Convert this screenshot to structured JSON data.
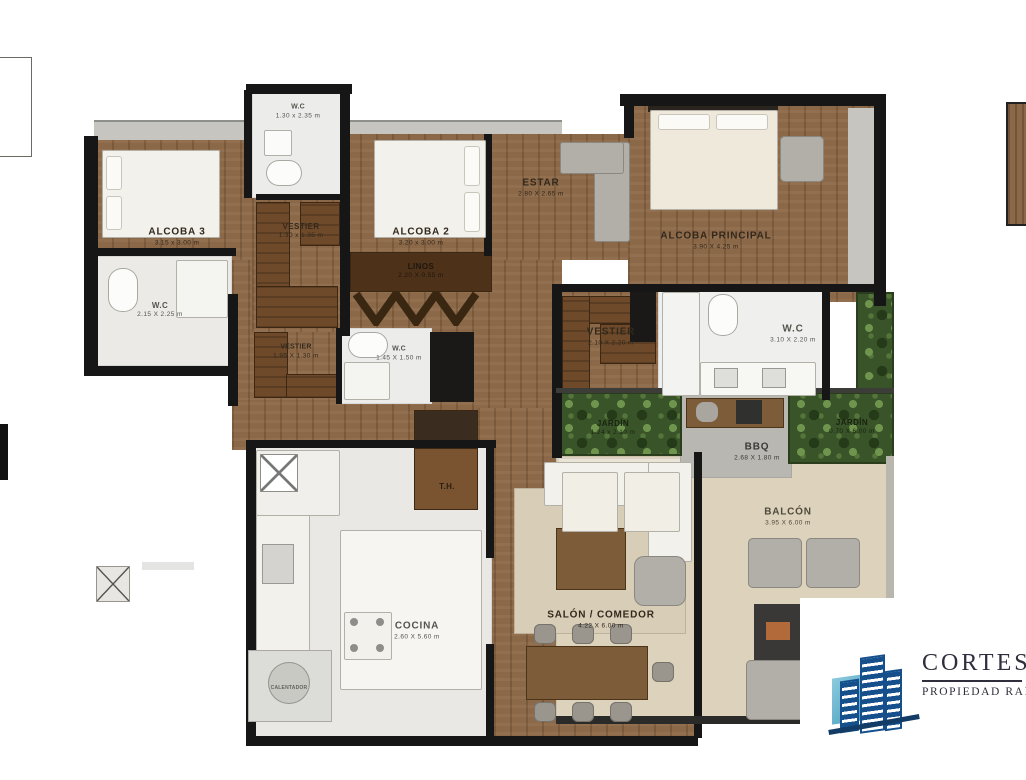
{
  "plan": {
    "rooms": [
      {
        "id": "wc-top",
        "label": "W.C",
        "dims": "1.30 x 2.35 m"
      },
      {
        "id": "alcoba-3",
        "label": "ALCOBA 3",
        "dims": "3.15 x 3.00 m"
      },
      {
        "id": "vestier-alcoba3",
        "label": "VESTIER",
        "dims": "1.30 x 1.35 m"
      },
      {
        "id": "alcoba-2",
        "label": "ALCOBA 2",
        "dims": "3.20 x 3.00 m"
      },
      {
        "id": "linos",
        "label": "LINOS",
        "dims": "2.20 X 0.55 m"
      },
      {
        "id": "estar",
        "label": "ESTAR",
        "dims": "2.80 X 2.65 m"
      },
      {
        "id": "alcoba-principal",
        "label": "ALCOBA PRINCIPAL",
        "dims": "3.90 X 4.25 m"
      },
      {
        "id": "wc-alcoba3",
        "label": "W.C",
        "dims": "2.15 X 2.25 m"
      },
      {
        "id": "vestier-centro",
        "label": "VESTIER",
        "dims": "1.95 X 1.30 m"
      },
      {
        "id": "wc-centro",
        "label": "W.C",
        "dims": "1.45 X 1.50 m"
      },
      {
        "id": "vestier-principal",
        "label": "VESTIER",
        "dims": "2.10 X 2.20 m"
      },
      {
        "id": "wc-principal",
        "label": "W.C",
        "dims": "3.10 X 2.20 m"
      },
      {
        "id": "jardin-izquierdo",
        "label": "JARDÍN",
        "dims": "1.24 x 2.10 m"
      },
      {
        "id": "bbq",
        "label": "BBQ",
        "dims": "2.68 X 1.80 m"
      },
      {
        "id": "jardin-derecho",
        "label": "JARDÍN",
        "dims": "0.70 X 6.00 m"
      },
      {
        "id": "balcon",
        "label": "BALCÓN",
        "dims": "3.95 X 6.00 m"
      },
      {
        "id": "th",
        "label": "T.H.",
        "dims": ""
      },
      {
        "id": "cocina",
        "label": "COCINA",
        "dims": "2.60 X 5.60 m"
      },
      {
        "id": "salon-comedor",
        "label": "SALÓN / COMEDOR",
        "dims": "4.22 X 6.00 m"
      },
      {
        "id": "calentador",
        "label": "CALENTADOR",
        "dims": ""
      }
    ]
  },
  "logo": {
    "name": "CORTES",
    "tagline": "PROPIEDAD RAÍZ",
    "brand_blue": "#15508d",
    "brand_teal": "#2e8fb4",
    "text_color": "#2e2e3c"
  },
  "colors": {
    "wood_floor": "#8b6848",
    "wall": "#161616",
    "closet_wood": "#6e4a2a",
    "balcony_tile": "#ddd2bc",
    "plants_green": "#3a5429"
  }
}
